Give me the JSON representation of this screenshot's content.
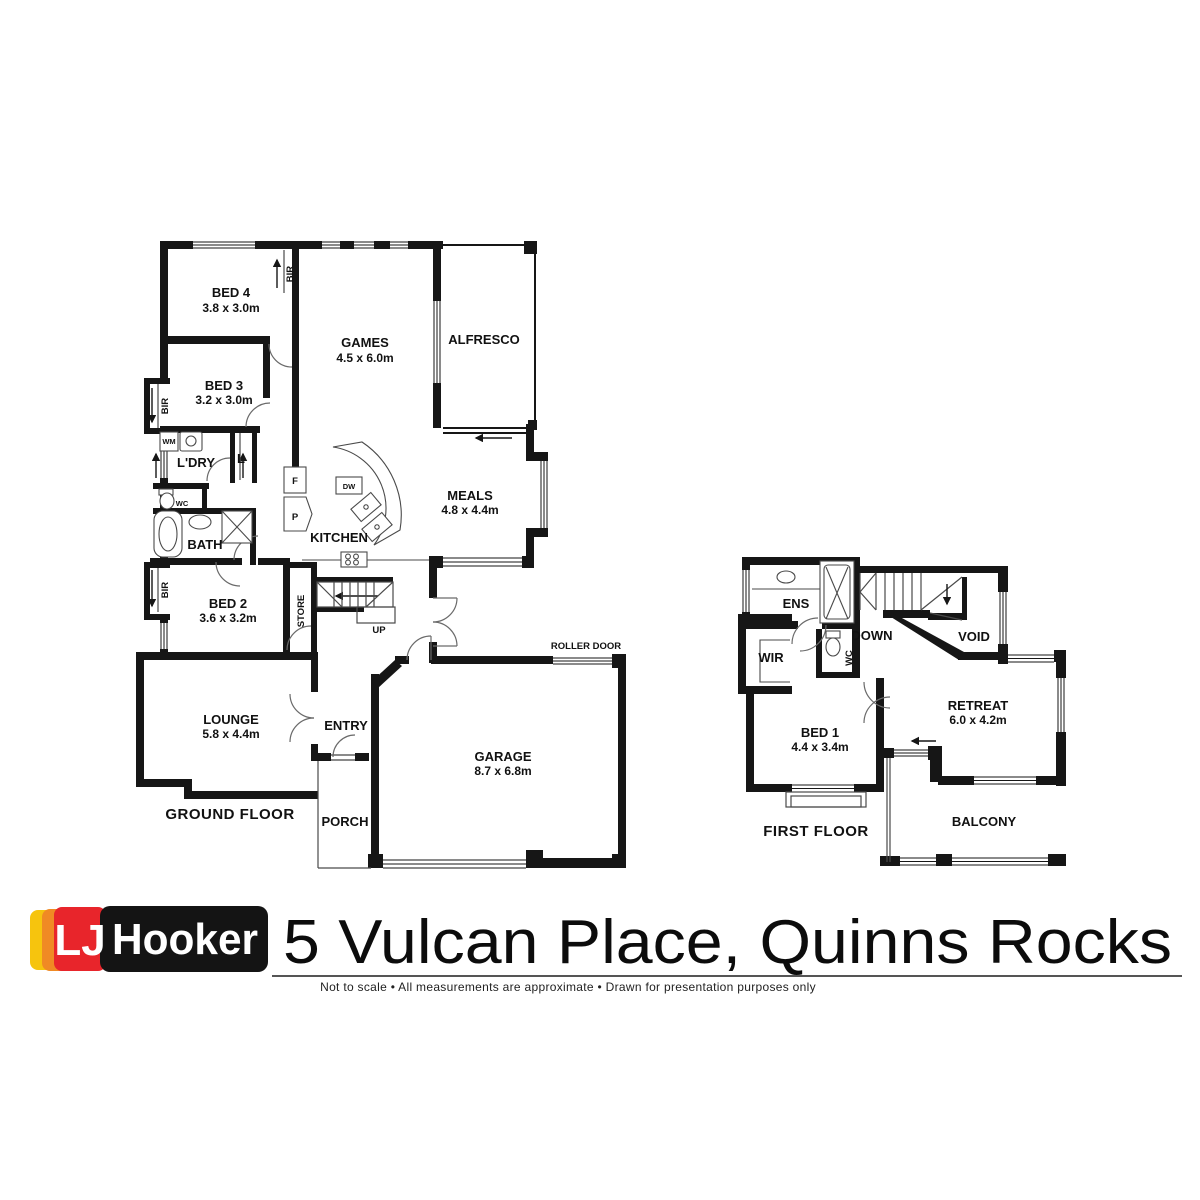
{
  "gf": {
    "floor_label": "GROUND FLOOR",
    "bed4": {
      "name": "BED 4",
      "dims": "3.8 x 3.0m"
    },
    "bed3": {
      "name": "BED 3",
      "dims": "3.2 x 3.0m"
    },
    "games": {
      "name": "GAMES",
      "dims": "4.5 x 6.0m"
    },
    "alfresco": {
      "name": "ALFRESCO"
    },
    "meals": {
      "name": "MEALS",
      "dims": "4.8 x 4.4m"
    },
    "kitchen": {
      "name": "KITCHEN"
    },
    "ldry": {
      "name": "L'DRY"
    },
    "bath": {
      "name": "BATH"
    },
    "bed2": {
      "name": "BED 2",
      "dims": "3.6 x 3.2m"
    },
    "lounge": {
      "name": "LOUNGE",
      "dims": "5.8 x 4.4m"
    },
    "entry": {
      "name": "ENTRY"
    },
    "porch": {
      "name": "PORCH"
    },
    "garage": {
      "name": "GARAGE",
      "dims": "8.7 x 6.8m"
    },
    "store": {
      "name": "STORE"
    },
    "up": {
      "name": "UP"
    },
    "roller_door": {
      "name": "ROLLER DOOR"
    },
    "labels": {
      "bir": "BIR",
      "wm": "WM",
      "linen": "L",
      "wc": "WC",
      "fridge": "F",
      "pantry": "P",
      "dw": "DW"
    }
  },
  "ff": {
    "floor_label": "FIRST FLOOR",
    "ens": {
      "name": "ENS"
    },
    "wir": {
      "name": "WIR"
    },
    "down": {
      "name": "DOWN"
    },
    "void": {
      "name": "VOID"
    },
    "bed1": {
      "name": "BED 1",
      "dims": "4.4 x 3.4m"
    },
    "retreat": {
      "name": "RETREAT",
      "dims": "6.0 x 4.2m"
    },
    "balcony": {
      "name": "BALCONY"
    },
    "labels": {
      "wc": "WC"
    }
  },
  "footer": {
    "logo": {
      "lj": "LJ",
      "hooker": "Hooker"
    },
    "address": "5 Vulcan Place, Quinns Rocks",
    "disclaimer": "Not to scale  •  All measurements are approximate  •  Drawn for presentation purposes only",
    "colors": {
      "yellow": "#F6C40E",
      "orange": "#F08A24",
      "red": "#E8252B",
      "black": "#141414"
    }
  }
}
